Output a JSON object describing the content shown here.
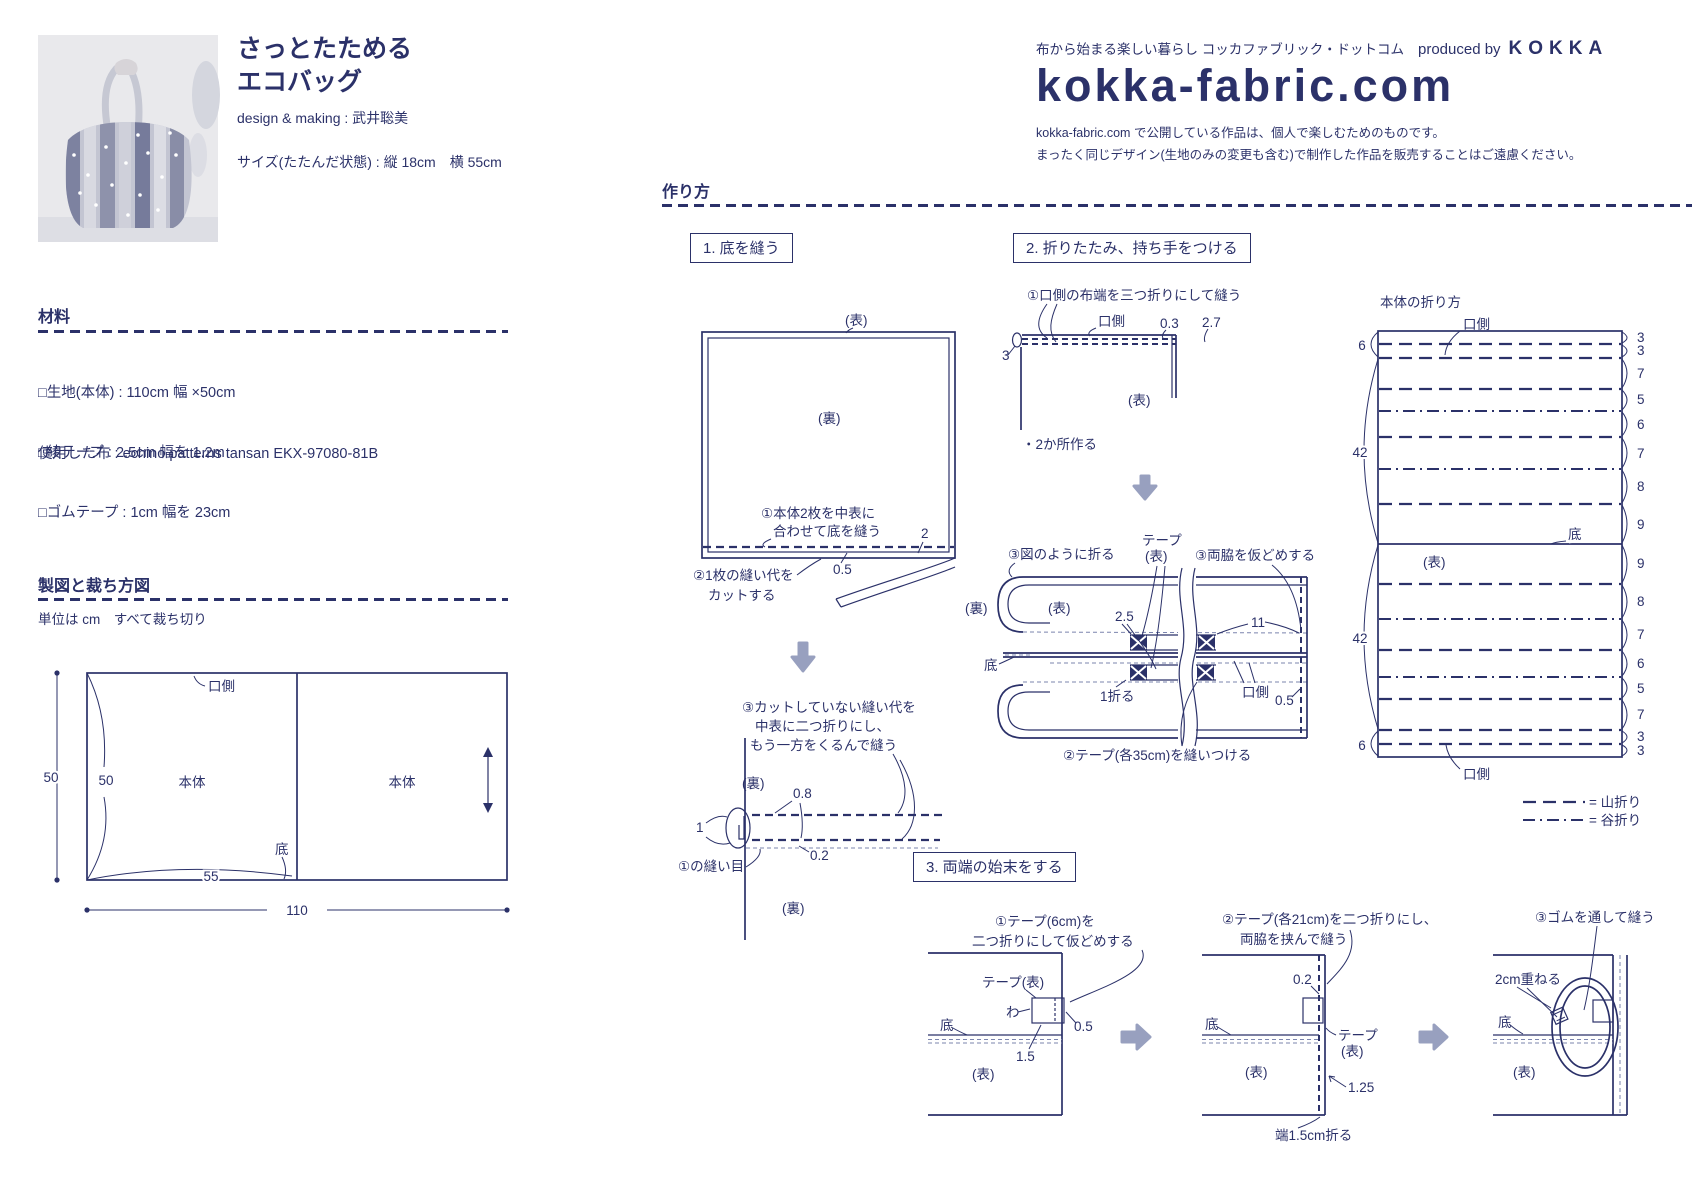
{
  "colors": {
    "ink": "#2b3169",
    "arrow_gray": "#98a0bf",
    "photo_bg": "#e9e9ec"
  },
  "header": {
    "title_line1": "さっとたためる",
    "title_line2": "エコバッグ",
    "credit": "design & making : 武井聡美",
    "size": "サイズ(たたんだ状態) : 縦 18cm　横 55cm"
  },
  "brand": {
    "tagline": "布から始まる楽しい暮らし コッカファブリック・ドットコム",
    "produced_by": "produced by",
    "kokka": "KOKKA",
    "logo": "kokka-fabric.com",
    "notice1": "kokka-fabric.com で公開している作品は、個人で楽しむためのものです。",
    "notice2": "まったく同じデザイン(生地のみの変更も含む)で制作した作品を販売することはご遠慮ください。"
  },
  "materials": {
    "heading": "材料",
    "item1": "□生地(本体) : 110cm 幅 ×50cm",
    "item2": "□綾テープ : 2.5cm 幅を 1.2m",
    "item3": "□ゴムテープ : 1cm 幅を 23cm",
    "fabric_used": "使用した布 : echino patterns tansan EKX-97080-81B"
  },
  "cutting": {
    "heading": "製図と裁ち方図",
    "note": "単位は cm　すべて裁ち切り",
    "kuchigawa": "口側",
    "hontai1": "本体",
    "hontai2": "本体",
    "soko": "底",
    "d50_outer": "50",
    "d50_inner": "50",
    "d55": "55",
    "d110": "110"
  },
  "howto": {
    "heading": "作り方"
  },
  "step1": {
    "box": "1. 底を縫う",
    "omote": "(表)",
    "ura": "(裏)",
    "sew_note_l1": "①本体2枚を中表に",
    "sew_note_l2": "合わせて底を縫う",
    "cut_note_l1": "②1枚の縫い代を",
    "cut_note_l2": "カットする",
    "d_05": "0.5",
    "d_2": "2",
    "roll_note_l1": "③カットしていない縫い代を",
    "roll_note_l2": "中表に二つ折りにし、",
    "roll_note_l3": "もう一方をくるんで縫う",
    "roll_ura": "(裏)",
    "d_08": "0.8",
    "d_1": "1",
    "seam_label": "①の縫い目",
    "d_02": "0.2",
    "bottom_ura": "(裏)"
  },
  "step2": {
    "box": "2. 折りたたみ、持ち手をつける",
    "hem_note": "①口側の布端を三つ折りにして縫う",
    "kuchigawa": "口側",
    "d_03": "0.3",
    "d_27": "2.7",
    "d_3": "3",
    "omote": "(表)",
    "two_places": "・2か所作る",
    "fold_note": "③図のように折る",
    "tape_l1": "テープ",
    "tape_l2": "(表)",
    "baste_note": "③両脇を仮どめする",
    "ura": "(裏)",
    "omote2": "(表)",
    "d_25": "2.5",
    "d_11": "11",
    "soko": "底",
    "fold_1": "1折る",
    "kuchigawa2": "口側",
    "d_05": "0.5",
    "tape_sew_note": "②テープ(各35cm)を縫いつける"
  },
  "fold": {
    "title": "本体の折り方",
    "kuchigawa_top": "口側",
    "kuchigawa_bottom": "口側",
    "soko": "底",
    "omote": "(表)",
    "left_dims": [
      "6",
      "42",
      "42",
      "6"
    ],
    "right_dims": [
      "3",
      "3",
      "7",
      "5",
      "6",
      "7",
      "8",
      "9",
      "9",
      "8",
      "7",
      "6",
      "5",
      "7",
      "3",
      "3"
    ],
    "legend_mountain": "= 山折り",
    "legend_valley": "= 谷折り"
  },
  "step3": {
    "box": "3. 両端の始末をする",
    "s1_l1": "①テープ(6cm)を",
    "s1_l2": "二つ折りにして仮どめする",
    "tape_omote": "テープ(表)",
    "wa": "わ",
    "soko": "底",
    "d_05": "0.5",
    "d_15": "1.5",
    "omote": "(表)",
    "s2_l1": "②テープ(各21cm)を二つ折りにし、",
    "s2_l2": "両脇を挟んで縫う",
    "d_02": "0.2",
    "soko2": "底",
    "tape_l1": "テープ",
    "tape_l2": "(表)",
    "omote2": "(表)",
    "d_125": "1.25",
    "edge_fold": "端1.5cm折る",
    "s3_note": "③ゴムを通して縫う",
    "overlap": "2cm重ねる",
    "soko3": "底",
    "omote3": "(表)"
  }
}
